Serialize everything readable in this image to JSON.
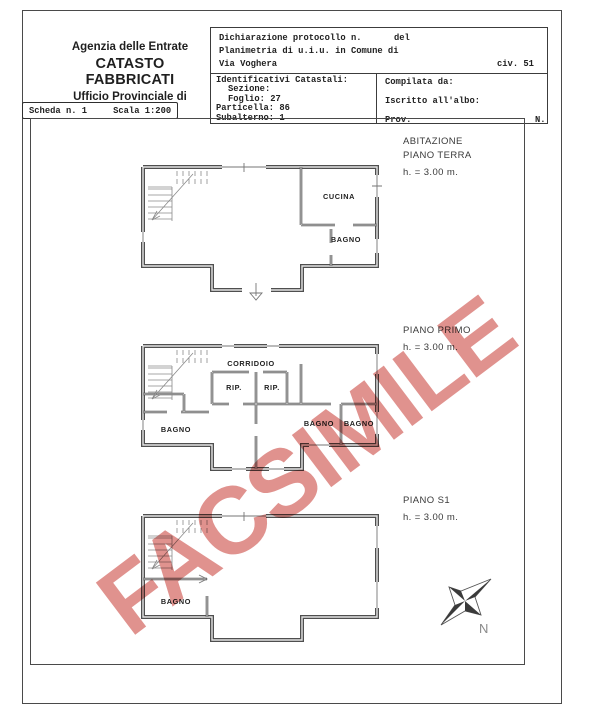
{
  "agency": {
    "line1": "Agenzia delle Entrate",
    "line2": "CATASTO FABBRICATI",
    "line3": "Ufficio Provinciale di"
  },
  "protocol": {
    "line1_label": "Dichiarazione protocollo n.",
    "line1_del": "del",
    "line2": "Planimetria di u.i.u. in Comune di",
    "line3_street": "Via Voghera",
    "line3_civ": "civ. 51"
  },
  "cadastral": {
    "title": "Identificativi Catastali:",
    "rows": [
      "Sezione:",
      "Foglio: 27",
      "Particella: 86",
      "Subalterno: 1"
    ]
  },
  "compiler": {
    "line1": "Compilata da:",
    "line2": "Iscritto all'albo:",
    "line3_prov": "Prov.",
    "line3_n": "N."
  },
  "scheda": {
    "label": "Scheda n. 1",
    "scale": "Scala 1:200"
  },
  "floors": [
    {
      "name": "piano-terra",
      "title_line1": "ABITAZIONE",
      "title_line2": "PIANO TERRA",
      "height": "h. = 3.00 m.",
      "rooms": {
        "cucina": "CUCINA",
        "bagno": "BAGNO"
      }
    },
    {
      "name": "piano-primo",
      "title_line1": "PIANO PRIMO",
      "height": "h. = 3.00 m.",
      "rooms": {
        "corridoio": "CORRIDOIO",
        "rip_left": "RIP.",
        "rip_right": "RIP.",
        "bagno_left": "BAGNO",
        "bagno_mid": "BAGNO",
        "bagno_right": "BAGNO"
      }
    },
    {
      "name": "piano-s1",
      "title_line1": "PIANO S1",
      "height": "h. = 3.00 m.",
      "rooms": {
        "bagno": "BAGNO"
      }
    }
  ],
  "compass": {
    "north_label": "N"
  },
  "watermark": {
    "text": "FACSIMILE",
    "color": "#dd8682"
  }
}
